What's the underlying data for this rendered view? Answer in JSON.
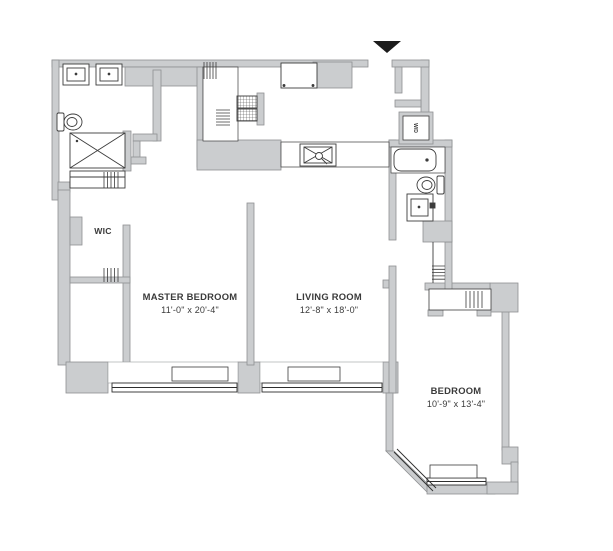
{
  "floor_plan": {
    "background": "#ffffff",
    "colors": {
      "wall_fill": "#cbcdcf",
      "wall_stroke": "#8e9092",
      "sill_stroke": "#9b9da0",
      "window_stroke": "#2e2e2e",
      "fixture_stroke": "#3c3c3c",
      "text": "#3a3a3a",
      "entry_marker": "#1c1c1c"
    },
    "rooms": {
      "master_bedroom": {
        "name": "MASTER BEDROOM",
        "dims": "11'-0\" x 20'-4\""
      },
      "living_room": {
        "name": "LIVING ROOM",
        "dims": "12'-8\" x 18'-0\""
      },
      "bedroom": {
        "name": "BEDROOM",
        "dims": "10'-9\" x 13'-4\""
      },
      "walk_in_closet": {
        "name": "WIC"
      },
      "washer_dryer": {
        "name": "W/D"
      }
    },
    "icons": {
      "entry_marker": "down-triangle-entry-arrow",
      "shower": "x-crossed-box",
      "kitchen_sink": "x-crossed-basin-with-faucet-circle",
      "stove": "two-hatched-burner-boxes",
      "closet_rods": "parallel-hatch-marks"
    }
  }
}
